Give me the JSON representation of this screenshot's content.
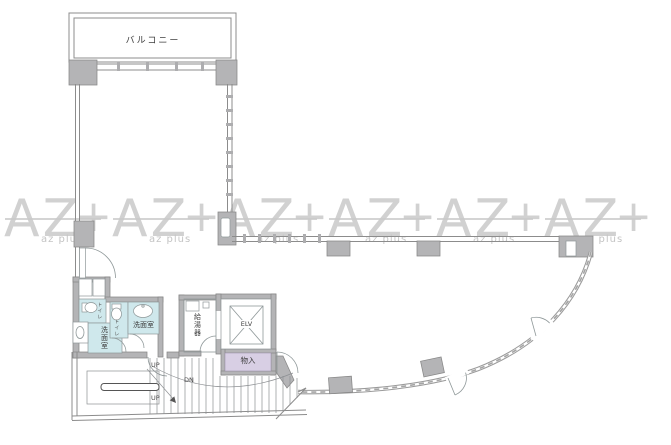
{
  "watermark": {
    "big": "AZ",
    "plus": "+",
    "small": "az plus"
  },
  "labels": {
    "balcony": "バルコニー",
    "toilet_a": "トイレ",
    "toilet_b": "トイレ",
    "washroom_a": "洗面室",
    "washroom_b": "洗面室",
    "water_heater": "給湯器",
    "elevator": "ELV",
    "storage": "物入",
    "up_top": "UP",
    "down": "DN",
    "up_bottom": "UP"
  },
  "colors": {
    "wall_fill": "#b4b4b6",
    "wall_line": "#8c8c8c",
    "wet_area": "#cfe8ec",
    "storage_area": "#d8cfe4",
    "watermark": "#c9c9c9"
  }
}
